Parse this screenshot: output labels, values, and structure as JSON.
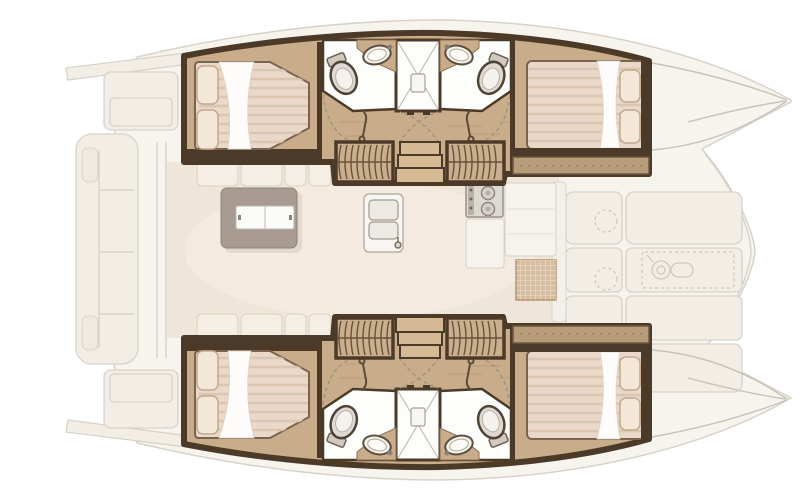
{
  "meta": {
    "aria_label": "Catamaran yacht interior layout floor plan, top-down view, bow pointing right",
    "diagram_type": "yacht-floorplan",
    "visible_text": []
  },
  "colors": {
    "background": "#ffffff",
    "deck_fill": "#f7f4ee",
    "deck_stroke": "#d8d3c9",
    "deck_detail": "#f2eee6",
    "wood_floor": "#c9ac8a",
    "wood_streak": "#b28e66",
    "trim_dark": "#4c3a28",
    "trim_mid": "#8a6f52",
    "shelf_wood": "#b79c79",
    "mattress": "#ead9c9",
    "mattress_stripe": "#dcc6b2",
    "pillow": "#f3e7d7",
    "sheet": "#fdfcfa",
    "bath_floor": "#fdfdfb",
    "porcelain": "#dedad3",
    "porcelain_stroke": "#4f4336",
    "saloon_floor": "#f0e5d9",
    "cushion": "#f5eee4",
    "table": "#a89c92",
    "table_leaf": "#fbfbfa",
    "stair_wood": "#c9af8e",
    "stair_line": "#6b5138",
    "step_wood": "#d6ba95",
    "mat": "#d7bda2",
    "mat_grid": "#efe2d0",
    "appliance": "#dcd8d2",
    "faded_line": "#c8c3ba"
  },
  "elements": {
    "hulls": 2,
    "cabins_with_double_bed": 4,
    "heads_with_toilet_and_sink": 4,
    "shower_stalls": 2,
    "companionway_stairs": 4,
    "icons": [
      "toilet-icon",
      "sink-icon",
      "shower-icon",
      "faucet-icon",
      "bed-icon",
      "pillow-icon",
      "stairs-icon",
      "dining-table-icon",
      "stove-icon",
      "double-sink-icon",
      "windlass-icon",
      "deck-hatch-icon",
      "door-swing-icon",
      "cockpit-bench-icon"
    ]
  }
}
